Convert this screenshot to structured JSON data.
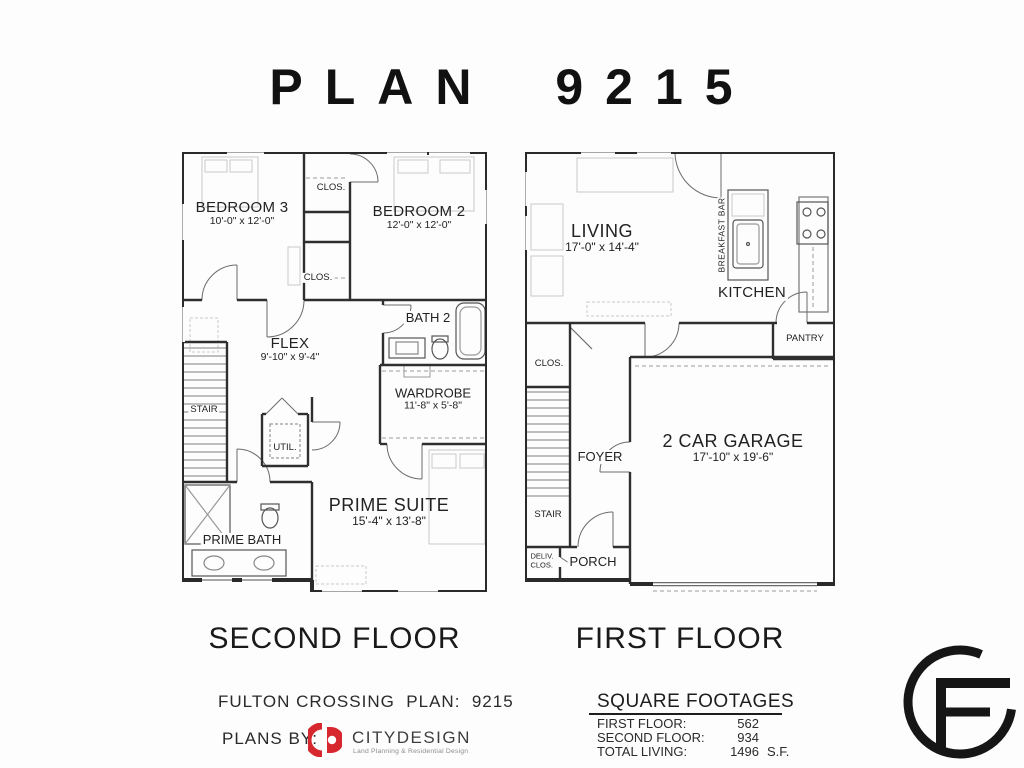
{
  "title": "PLAN 9215",
  "second_floor": {
    "caption": "SECOND FLOOR",
    "rooms": {
      "bedroom3": {
        "name": "BEDROOM 3",
        "dims": "10'-0\" x 12'-0\""
      },
      "clos_top": {
        "name": "CLOS."
      },
      "bedroom2": {
        "name": "BEDROOM 2",
        "dims": "12'-0\" x 12'-0\""
      },
      "clos_mid": {
        "name": "CLOS."
      },
      "bath2": {
        "name": "BATH 2"
      },
      "flex": {
        "name": "FLEX",
        "dims": "9'-10\" x 9'-4\""
      },
      "wardrobe": {
        "name": "WARDROBE",
        "dims": "11'-8\" x 5'-8\""
      },
      "stair": {
        "name": "STAIR"
      },
      "util": {
        "name": "UTIL."
      },
      "prime_bath": {
        "name": "PRIME BATH"
      },
      "prime_suite": {
        "name": "PRIME SUITE",
        "dims": "15'-4\" x 13'-8\""
      }
    }
  },
  "first_floor": {
    "caption": "FIRST FLOOR",
    "rooms": {
      "living": {
        "name": "LIVING",
        "dims": "17'-0\" x 14'-4\""
      },
      "breakfast_bar": {
        "name": "BREAKFAST BAR"
      },
      "kitchen": {
        "name": "KITCHEN"
      },
      "pantry": {
        "name": "PANTRY"
      },
      "clos": {
        "name": "CLOS."
      },
      "foyer": {
        "name": "FOYER"
      },
      "stair": {
        "name": "STAIR"
      },
      "garage": {
        "name": "2 CAR GARAGE",
        "dims": "17'-10\" x 19'-6\""
      },
      "deliv_clos": {
        "line1": "DELIV.",
        "line2": "CLOS."
      },
      "porch": {
        "name": "PORCH"
      }
    }
  },
  "footer": {
    "project_line": "FULTON CROSSING  PLAN:  9215",
    "plans_by": "PLANS BY:",
    "designer": "CITYDESIGN",
    "designer_tagline": "Land Planning & Residential Design",
    "logo_color": "#d7282f"
  },
  "square_footages": {
    "heading": "SQUARE FOOTAGES",
    "rows": [
      {
        "label": "FIRST FLOOR:",
        "value": "562",
        "unit": ""
      },
      {
        "label": "SECOND FLOOR:",
        "value": "934",
        "unit": ""
      },
      {
        "label": "TOTAL LIVING:",
        "value": "1496",
        "unit": "S.F."
      }
    ]
  }
}
